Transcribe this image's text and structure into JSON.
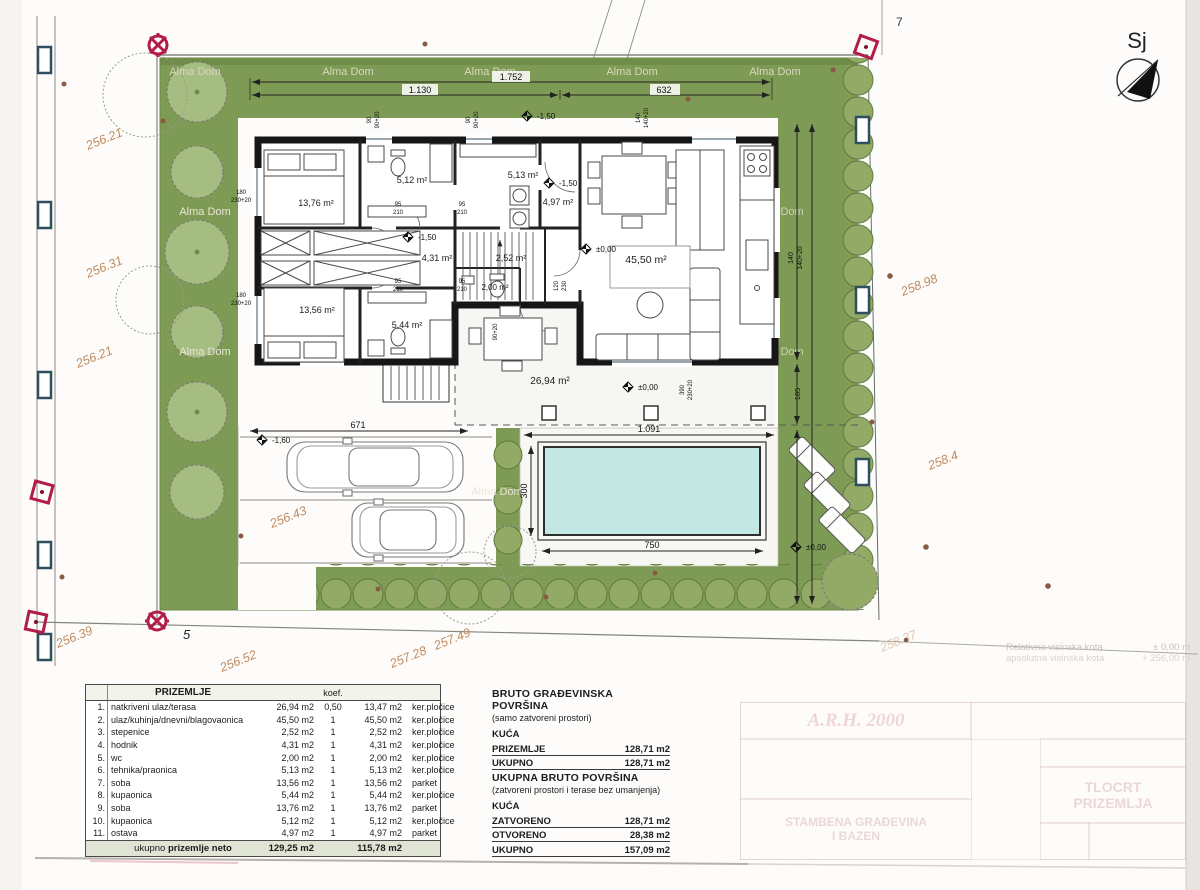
{
  "watermark": "Alma Dom",
  "north": {
    "label": "Sj"
  },
  "colors": {
    "lawn": "#7e9b55",
    "pool_water": "#c3e8e3",
    "marker_red": "#b31c4a",
    "elevation_text": "#c08a5e"
  },
  "site": {
    "parcel_point_5": "5",
    "parcel_point_7": "7",
    "elevations": {
      "left": [
        "256.21",
        "256.31",
        "256.21"
      ],
      "bottom": [
        "256.39",
        "256.52",
        "257.28",
        "257.49",
        "258.37"
      ],
      "right": [
        "258.98",
        "258.4"
      ],
      "driveway": "256.43"
    },
    "level_marks": {
      "minus150": "-1,50",
      "minus160": "-1,60",
      "zero": "±0,00"
    }
  },
  "dims": {
    "top_total": "1.752",
    "top_left": "1.130",
    "top_right": "632",
    "parking": "671",
    "pool_outer": "1.091",
    "pool_len": "750",
    "pool_wid": "300",
    "right_house_a": "140",
    "right_house_b": "140+20",
    "right_gap": "185",
    "win_90": "90",
    "win_90_20": "90+20",
    "win_180": "180",
    "win_230_20": "230+20",
    "door_95": "95",
    "door_210": "210",
    "door_120": "120",
    "door_230": "230",
    "terr_390": "390"
  },
  "rooms": {
    "bedroom1": "13,76 m²",
    "bath1": "5,12 m²",
    "tech": "5,13 m²",
    "storage": "4,97 m²",
    "hall": "4,31 m²",
    "stairs": "2,52 m²",
    "wc": "2,00 m²",
    "bedroom2": "13,56 m²",
    "bath2": "5,44 m²",
    "living": "45,50 m²",
    "terrace": "26,94 m²"
  },
  "table": {
    "title": "PRIZEMLJE",
    "koef": "koef.",
    "rows": [
      {
        "n": "1.",
        "name": "natkriveni ulaz/terasa",
        "a": "26,94 m2",
        "k": "0,50",
        "r": "13,47 m2",
        "f": "ker.pločice"
      },
      {
        "n": "2.",
        "name": "ulaz/kuhinja/dnevni/blagovaonica",
        "a": "45,50 m2",
        "k": "1",
        "r": "45,50 m2",
        "f": "ker.pločice"
      },
      {
        "n": "3.",
        "name": "stepenice",
        "a": "2,52 m2",
        "k": "1",
        "r": "2,52 m2",
        "f": "ker.pločice"
      },
      {
        "n": "4.",
        "name": "hodnik",
        "a": "4,31 m2",
        "k": "1",
        "r": "4,31 m2",
        "f": "ker.pločice"
      },
      {
        "n": "5.",
        "name": "wc",
        "a": "2,00 m2",
        "k": "1",
        "r": "2,00 m2",
        "f": "ker.pločice"
      },
      {
        "n": "6.",
        "name": "tehnika/praonica",
        "a": "5,13 m2",
        "k": "1",
        "r": "5,13 m2",
        "f": "ker.pločice"
      },
      {
        "n": "7.",
        "name": "soba",
        "a": "13,56 m2",
        "k": "1",
        "r": "13,56 m2",
        "f": "parket"
      },
      {
        "n": "8.",
        "name": "kupaonica",
        "a": "5,44 m2",
        "k": "1",
        "r": "5,44 m2",
        "f": "ker.pločice"
      },
      {
        "n": "9.",
        "name": "soba",
        "a": "13,76 m2",
        "k": "1",
        "r": "13,76 m2",
        "f": "parket"
      },
      {
        "n": "10.",
        "name": "kupaonica",
        "a": "5,12 m2",
        "k": "1",
        "r": "5,12 m2",
        "f": "ker.pločice"
      },
      {
        "n": "11.",
        "name": "ostava",
        "a": "4,97 m2",
        "k": "1",
        "r": "4,97 m2",
        "f": "parket"
      }
    ],
    "total_pre": "ukupno",
    "total_bold": "prizemlje neto",
    "total_a": "129,25 m2",
    "total_r": "115,78 m2"
  },
  "gross1": {
    "title": "BRUTO GRAĐEVINSKA POVRŠINA",
    "subtitle": "(samo zatvoreni prostori)",
    "group": "KUĆA",
    "rows": [
      {
        "label": "PRIZEMLJE",
        "value": "128,71 m2"
      },
      {
        "label": "UKUPNO",
        "value": "128,71 m2"
      }
    ]
  },
  "gross2": {
    "title": "UKUPNA BRUTO POVRŠINA",
    "subtitle": "(zatvoreni prostori i terase bez umanjenja)",
    "group": "KUĆA",
    "rows": [
      {
        "label": "ZATVORENO",
        "value": "128,71 m2"
      },
      {
        "label": "OTVORENO",
        "value": "28,38 m2"
      },
      {
        "label": "UKUPNO",
        "value": "157,09 m2"
      }
    ]
  },
  "legend": {
    "rel_label": "Relativna visinska kota",
    "rel_value": "± 0,00 m",
    "abs_label": "apsolutna visinska kota",
    "abs_value": "+ 256,00 m"
  },
  "titleblock": {
    "logo": "A.R.H. 2000",
    "project1": "STAMBENA GRAĐEVINA",
    "project2": "I BAZEN",
    "drawing": "TLOCRT",
    "drawing2": "PRIZEMLJA"
  }
}
